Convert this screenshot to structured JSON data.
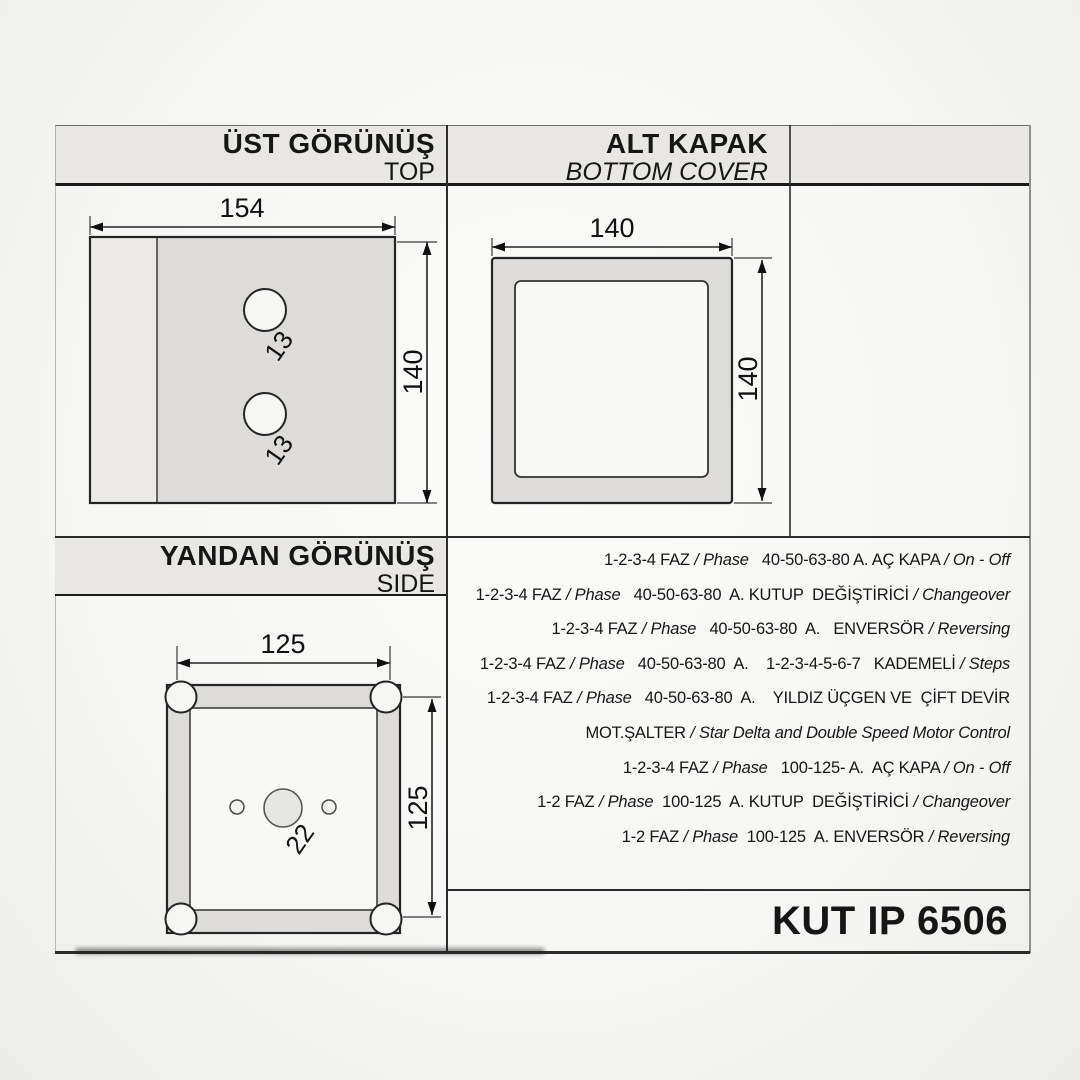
{
  "page": {
    "product_code": "KUT IP 6506"
  },
  "sections": {
    "top_view": {
      "title": "ÜST GÖRÜNÜŞ",
      "subtitle": "TOP",
      "dims": {
        "width": "154",
        "height": "140",
        "hole_diameter": "13"
      }
    },
    "bottom_cover": {
      "title": "ALT KAPAK",
      "subtitle": "BOTTOM COVER",
      "dims": {
        "width": "140",
        "height": "140"
      }
    },
    "side_view": {
      "title": "YANDAN GÖRÜNÜŞ",
      "subtitle": "SIDE",
      "dims": {
        "width": "125",
        "height": "125",
        "hole_diameter": "22"
      }
    }
  },
  "spec": {
    "lines": [
      {
        "parts": [
          {
            "t": "1-2-3-4 FAZ ",
            "i": 0
          },
          {
            "t": "/ Phase",
            "i": 1
          },
          {
            "t": "   40-50-63-80 A. AÇ KAPA ",
            "i": 0
          },
          {
            "t": "/ On - Off",
            "i": 1
          }
        ]
      },
      {
        "parts": [
          {
            "t": "1-2-3-4 FAZ ",
            "i": 0
          },
          {
            "t": "/ Phase",
            "i": 1
          },
          {
            "t": "   40-50-63-80  A. KUTUP  DEĞİŞTİRİCİ ",
            "i": 0
          },
          {
            "t": "/ Changeover",
            "i": 1
          }
        ]
      },
      {
        "parts": [
          {
            "t": "1-2-3-4 FAZ ",
            "i": 0
          },
          {
            "t": "/ Phase",
            "i": 1
          },
          {
            "t": "   40-50-63-80  A.   ENVERSÖR ",
            "i": 0
          },
          {
            "t": "/ Reversing",
            "i": 1
          }
        ]
      },
      {
        "parts": [
          {
            "t": "1-2-3-4 FAZ ",
            "i": 0
          },
          {
            "t": "/ Phase",
            "i": 1
          },
          {
            "t": "   40-50-63-80  A.    1-2-3-4-5-6-7   KADEMELİ ",
            "i": 0
          },
          {
            "t": "/ Steps",
            "i": 1
          }
        ]
      },
      {
        "parts": [
          {
            "t": "1-2-3-4 FAZ ",
            "i": 0
          },
          {
            "t": "/ Phase",
            "i": 1
          },
          {
            "t": "   40-50-63-80  A.    YILDIZ ÜÇGEN VE  ÇİFT DEVİR",
            "i": 0
          }
        ]
      },
      {
        "parts": [
          {
            "t": "MOT.ŞALTER ",
            "i": 0
          },
          {
            "t": "/ Star Delta and Double Speed Motor Control",
            "i": 1
          }
        ]
      },
      {
        "parts": [
          {
            "t": "1-2-3-4 FAZ ",
            "i": 0
          },
          {
            "t": "/ Phase",
            "i": 1
          },
          {
            "t": "   100-125- A.  AÇ KAPA ",
            "i": 0
          },
          {
            "t": "/ On - Off",
            "i": 1
          }
        ]
      },
      {
        "parts": [
          {
            "t": "1-2 FAZ ",
            "i": 0
          },
          {
            "t": "/ Phase",
            "i": 1
          },
          {
            "t": "  100-125  A. KUTUP  DEĞİŞTİRİCİ ",
            "i": 0
          },
          {
            "t": "/ Changeover",
            "i": 1
          }
        ]
      },
      {
        "parts": [
          {
            "t": "1-2 FAZ ",
            "i": 0
          },
          {
            "t": "/ Phase",
            "i": 1
          },
          {
            "t": "  100-125  A. ENVERSÖR ",
            "i": 0
          },
          {
            "t": "/ Reversing",
            "i": 1
          }
        ]
      }
    ]
  },
  "colors": {
    "header_bg": "#e8e7e4",
    "panel_gray": "#dddcda",
    "panel_light": "#ecebe8",
    "paper": "#f8f8f6",
    "line": "#1b1b1b"
  }
}
